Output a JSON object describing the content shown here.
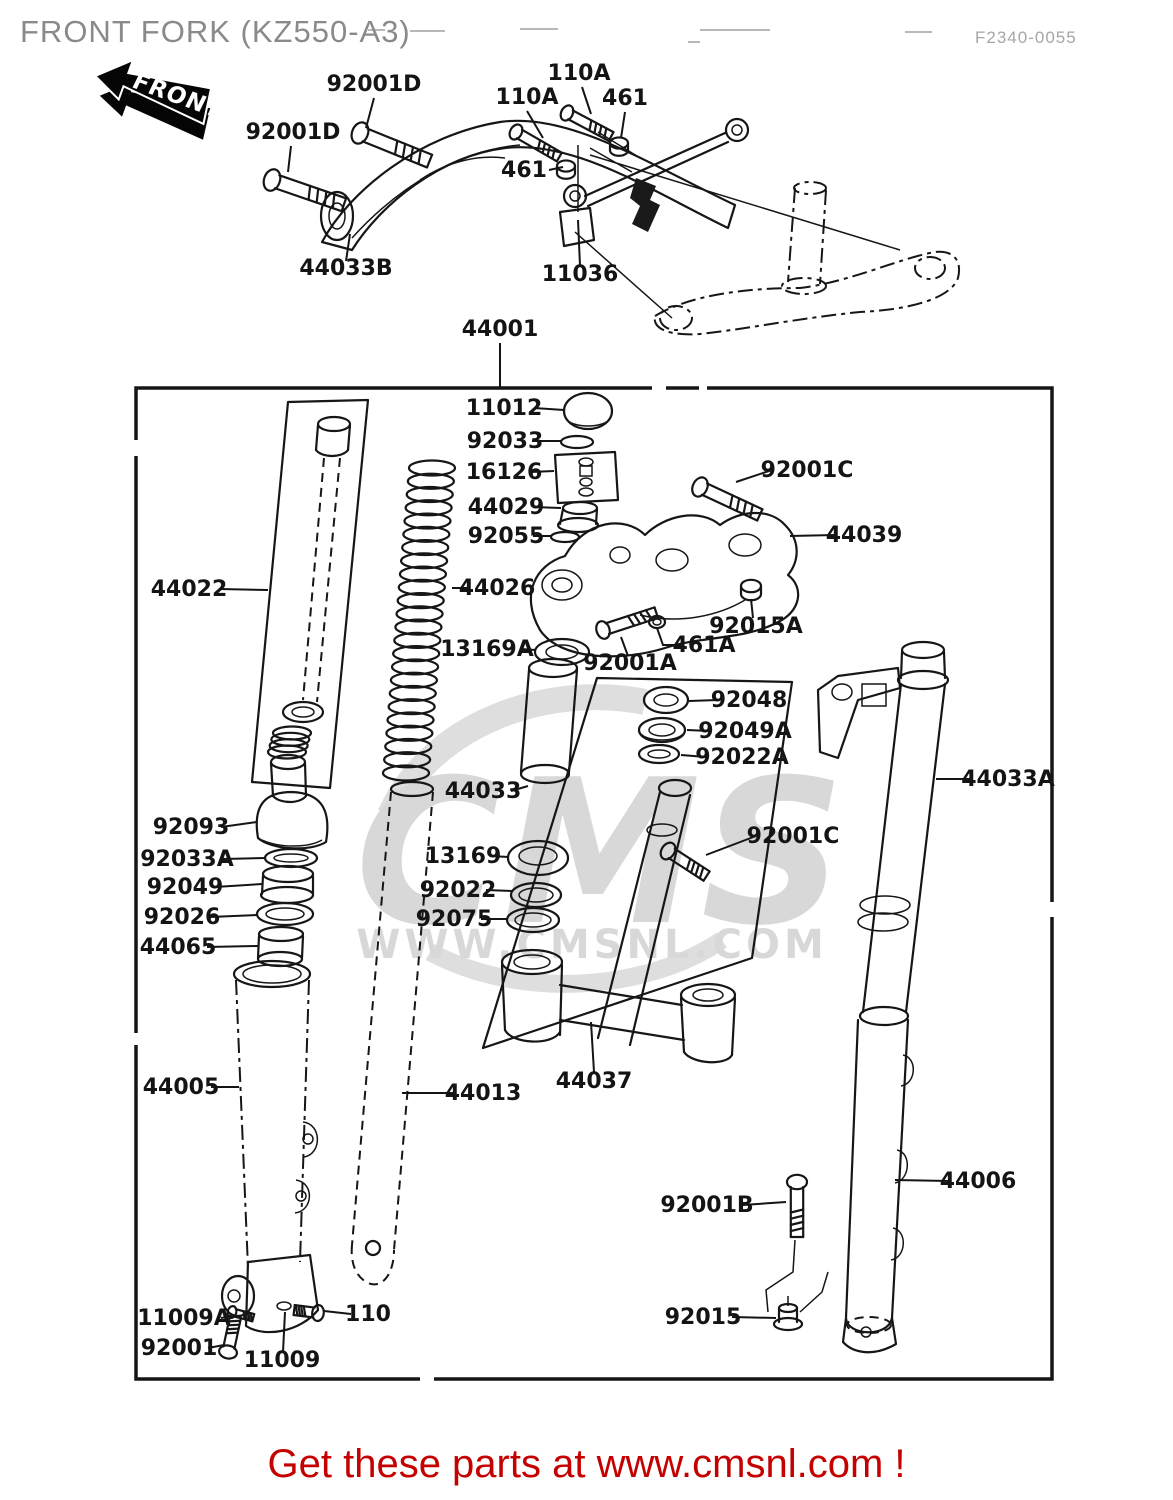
{
  "header": {
    "title": "FRONT FORK (KZ550-A3)",
    "fiche_code": "F2340-0055"
  },
  "front_badge": {
    "label": "FRONT"
  },
  "watermark": {
    "big": "CMS",
    "url": "WWW.CMSNL.COM",
    "color": "#d8d8d8"
  },
  "footer": {
    "text": "Get these parts at www.cmsnl.com !",
    "color": "#c40000"
  },
  "labels": [
    {
      "text": "92001D",
      "x": 374,
      "y": 91,
      "anchor": "middle",
      "leader": "M374,98 L366,128"
    },
    {
      "text": "92001D",
      "x": 293,
      "y": 139,
      "anchor": "middle",
      "leader": "M291,146 L288,172"
    },
    {
      "text": "110A",
      "x": 527,
      "y": 104,
      "anchor": "middle",
      "leader": "M527,111 L543,138"
    },
    {
      "text": "110A",
      "x": 579,
      "y": 80,
      "anchor": "middle",
      "leader": "M582,87 L591,114"
    },
    {
      "text": "461",
      "x": 625,
      "y": 105,
      "anchor": "middle",
      "leader": "M625,112 L621,138"
    },
    {
      "text": "461",
      "x": 524,
      "y": 177,
      "anchor": "middle",
      "leader": "M549,170 L563,167"
    },
    {
      "text": "44033B",
      "x": 346,
      "y": 275,
      "anchor": "middle",
      "leader": "M346,261 L350,234"
    },
    {
      "text": "11036",
      "x": 580,
      "y": 281,
      "anchor": "middle",
      "leader": "M580,266 L578,220"
    },
    {
      "text": "44001",
      "x": 500,
      "y": 336,
      "anchor": "middle",
      "leader": "M500,343 L500,388"
    },
    {
      "text": "11012",
      "x": 504,
      "y": 415,
      "anchor": "middle",
      "leader": "M534,408 L564,410"
    },
    {
      "text": "92033",
      "x": 505,
      "y": 448,
      "anchor": "middle",
      "leader": "M532,441 L561,441"
    },
    {
      "text": "16126",
      "x": 504,
      "y": 479,
      "anchor": "middle",
      "leader": "M531,472 L554,471"
    },
    {
      "text": "44029",
      "x": 506,
      "y": 514,
      "anchor": "middle",
      "leader": "M533,507 L561,508"
    },
    {
      "text": "92055",
      "x": 506,
      "y": 543,
      "anchor": "middle",
      "leader": "M533,536 L552,536"
    },
    {
      "text": "92001C",
      "x": 807,
      "y": 477,
      "anchor": "middle",
      "leader": "M772,470 L736,482"
    },
    {
      "text": "44039",
      "x": 864,
      "y": 542,
      "anchor": "middle",
      "leader": "M835,535 L790,536"
    },
    {
      "text": "44022",
      "x": 189,
      "y": 596,
      "anchor": "middle",
      "leader": "M219,589 L268,590"
    },
    {
      "text": "44026",
      "x": 497,
      "y": 595,
      "anchor": "middle",
      "leader": "M470,588 L452,588"
    },
    {
      "text": "13169A",
      "x": 487,
      "y": 656,
      "anchor": "middle",
      "leader": "M520,649 L536,650"
    },
    {
      "text": "92001A",
      "x": 630,
      "y": 670,
      "anchor": "middle",
      "leader": "M628,656 L621,637"
    },
    {
      "text": "461A",
      "x": 704,
      "y": 652,
      "anchor": "middle",
      "leader": "M681,645 L663,645 L657,628"
    },
    {
      "text": "92015A",
      "x": 756,
      "y": 633,
      "anchor": "middle",
      "leader": "M753,618 L751,599"
    },
    {
      "text": "92048",
      "x": 749,
      "y": 707,
      "anchor": "middle",
      "leader": "M718,700 L689,701"
    },
    {
      "text": "92049A",
      "x": 745,
      "y": 738,
      "anchor": "middle",
      "leader": "M710,731 L687,730"
    },
    {
      "text": "92022A",
      "x": 742,
      "y": 764,
      "anchor": "middle",
      "leader": "M706,757 L681,755"
    },
    {
      "text": "44033",
      "x": 483,
      "y": 798,
      "anchor": "middle",
      "leader": "M511,791 L528,786"
    },
    {
      "text": "92001C",
      "x": 793,
      "y": 843,
      "anchor": "middle",
      "leader": "M756,836 L706,855"
    },
    {
      "text": "13169",
      "x": 463,
      "y": 863,
      "anchor": "middle",
      "leader": "M490,856 L509,857"
    },
    {
      "text": "92022",
      "x": 458,
      "y": 897,
      "anchor": "middle",
      "leader": "M486,890 L512,891"
    },
    {
      "text": "92075",
      "x": 454,
      "y": 926,
      "anchor": "middle",
      "leader": "M481,919 L508,919"
    },
    {
      "text": "92093",
      "x": 191,
      "y": 834,
      "anchor": "middle",
      "leader": "M221,827 L257,822"
    },
    {
      "text": "92033A",
      "x": 187,
      "y": 866,
      "anchor": "middle",
      "leader": "M223,859 L265,858"
    },
    {
      "text": "92049",
      "x": 185,
      "y": 894,
      "anchor": "middle",
      "leader": "M215,887 L262,884"
    },
    {
      "text": "92026",
      "x": 182,
      "y": 924,
      "anchor": "middle",
      "leader": "M210,917 L257,915"
    },
    {
      "text": "44065",
      "x": 178,
      "y": 954,
      "anchor": "middle",
      "leader": "M207,947 L258,946"
    },
    {
      "text": "44005",
      "x": 181,
      "y": 1094,
      "anchor": "middle",
      "leader": "M211,1087 L239,1087"
    },
    {
      "text": "44013",
      "x": 483,
      "y": 1100,
      "anchor": "middle",
      "leader": "M455,1093 L402,1093"
    },
    {
      "text": "44037",
      "x": 594,
      "y": 1088,
      "anchor": "middle",
      "leader": "M594,1072 L591,1022"
    },
    {
      "text": "44033A",
      "x": 1008,
      "y": 786,
      "anchor": "middle",
      "leader": "M972,779 L936,779"
    },
    {
      "text": "44006",
      "x": 978,
      "y": 1188,
      "anchor": "middle",
      "leader": "M949,1181 L895,1180"
    },
    {
      "text": "92001B",
      "x": 707,
      "y": 1212,
      "anchor": "middle",
      "leader": "M743,1205 L786,1202"
    },
    {
      "text": "92015",
      "x": 703,
      "y": 1324,
      "anchor": "middle",
      "leader": "M732,1317 L776,1318"
    },
    {
      "text": "11009A",
      "x": 184,
      "y": 1325,
      "anchor": "middle",
      "leader": "M221,1318 L233,1316"
    },
    {
      "text": "92001",
      "x": 179,
      "y": 1355,
      "anchor": "middle",
      "leader": "M208,1348 L224,1345"
    },
    {
      "text": "110",
      "x": 368,
      "y": 1321,
      "anchor": "middle",
      "leader": "M351,1314 L324,1311"
    },
    {
      "text": "11009",
      "x": 282,
      "y": 1367,
      "anchor": "middle",
      "leader": "M283,1352 L285,1312"
    }
  ]
}
